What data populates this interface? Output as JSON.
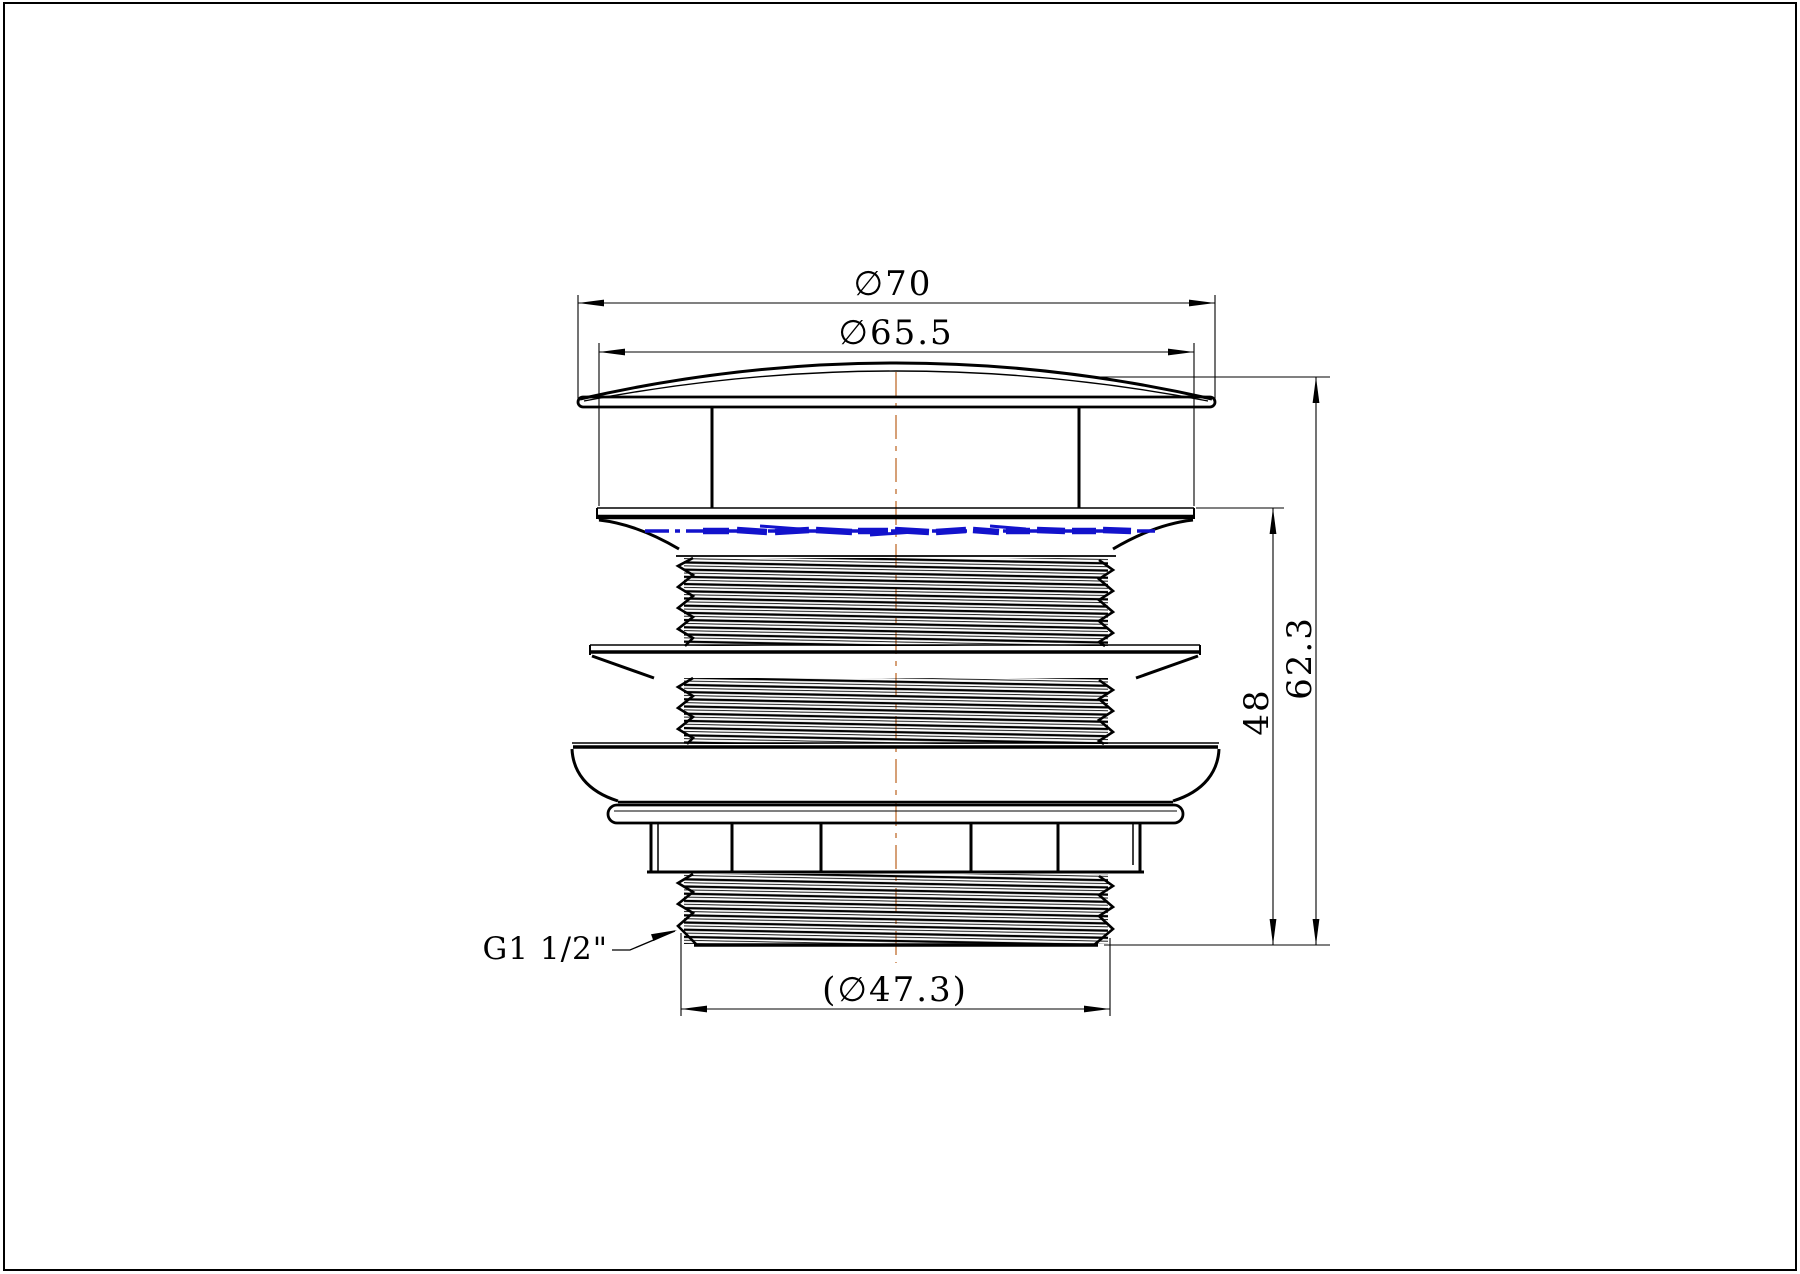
{
  "drawing": {
    "type": "technical-drawing",
    "view": "front-section-view-of-basin-waste-drain-fitting",
    "labels": {
      "dia_cap": "∅70",
      "dia_flange": "∅65.5",
      "height_total": "62.3",
      "height_thread": "48",
      "dia_thread": "(∅47.3)",
      "thread_spec": "G1 1/2\""
    },
    "colors": {
      "outline": "#000000",
      "centerline": "#cc8855",
      "watermark_line": "#1212cc",
      "background": "#ffffff"
    }
  }
}
